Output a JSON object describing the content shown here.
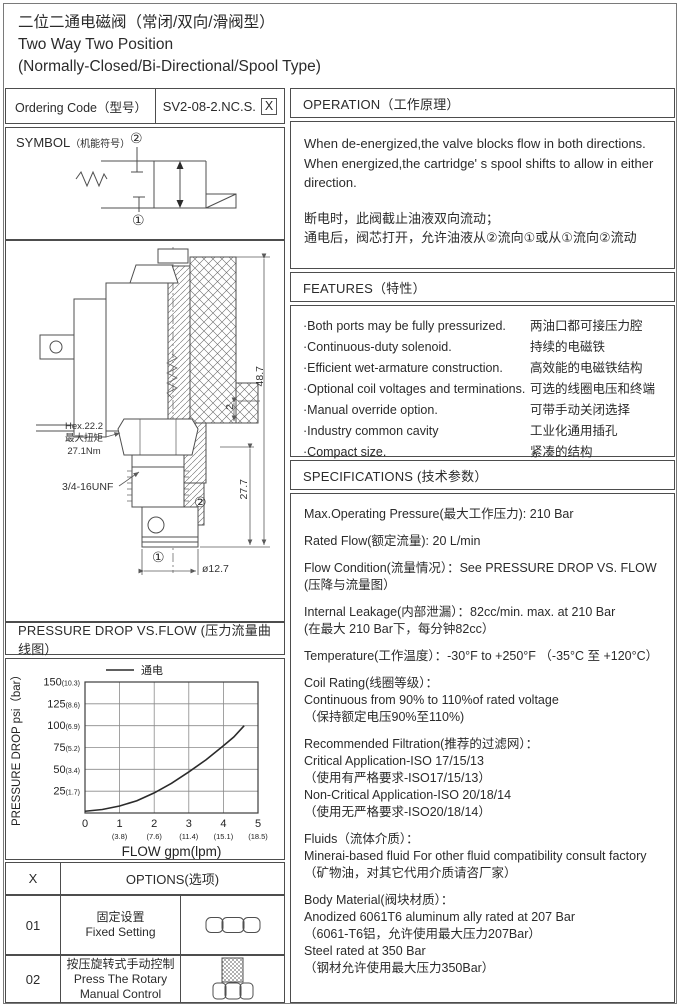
{
  "page": {
    "title_cn": "二位二通电磁阀（常闭/双向/滑阀型）",
    "title_en1": "Two Way Two Position",
    "title_en2": "(Normally-Closed/Bi-Directional/Spool Type)"
  },
  "ordering": {
    "label": "Ordering Code（型号）",
    "code": "SV2-08-2.NC.S.",
    "code_suffix": "X"
  },
  "symbol": {
    "label": "SYMBOL",
    "label_cn": "（机能符号）",
    "port_top": "②",
    "port_bottom": "①"
  },
  "drawing": {
    "hex_line1": "Hex.22.2",
    "hex_line2": "最大扭矩",
    "hex_line3": "27.1Nm",
    "thread": "3/4-16UNF",
    "dim_height": "48.7",
    "dim_mid": "27.7",
    "dim_flange": "2",
    "dim_diameter": "ø12.7",
    "port_top": "②",
    "port_bottom": "①"
  },
  "operation": {
    "header": "OPERATION（工作原理）",
    "en": "When de-energized,the valve blocks flow in both directions. When energized,the cartridge' s spool shifts to allow in either direction.",
    "cn1": "断电时，此阀截止油液双向流动；",
    "cn2": "通电后，阀芯打开，允许油液从②流向①或从①流向②流动"
  },
  "features": {
    "header": "FEATURES（特性）",
    "items": [
      {
        "en": "·Both ports may be fully pressurized.",
        "cn": "两油口都可接压力腔"
      },
      {
        "en": "·Continuous-duty  solenoid.",
        "cn": "持续的电磁铁"
      },
      {
        "en": "·Efficient wet-armature construction.",
        "cn": "高效能的电磁铁结构"
      },
      {
        "en": "·Optional coil voltages and terminations.",
        "cn": "可选的线圈电压和终端"
      },
      {
        "en": "·Manual override option.",
        "cn": "可带手动关闭选择"
      },
      {
        "en": "·Industry common cavity",
        "cn": "工业化通用插孔"
      },
      {
        "en": "·Compact size.",
        "cn": "紧凑的结构"
      }
    ]
  },
  "specifications": {
    "header": "SPECIFICATIONS (技术参数）",
    "paragraphs": [
      [
        "Max.Operating Pressure(最大工作压力): 210 Bar"
      ],
      [
        "Rated Flow(额定流量): 20 L/min"
      ],
      [
        "Flow Condition(流量情况）：See PRESSURE DROP VS. FLOW",
        "(压降与流量图）"
      ],
      [
        "Internal Leakage(内部泄漏）：82cc/min. max. at 210 Bar",
        "(在最大 210 Bar下，每分钟82cc）"
      ],
      [
        "Temperature(工作温度）：-30°F to +250°F （-35°C 至 +120°C）"
      ],
      [
        "Coil Rating(线圈等级）：",
        "Continuous from 90% to 110%of rated voltage",
        "（保持额定电压90%至110%)"
      ],
      [
        "Recommended Filtration(推荐的过滤网）：",
        "Critical Application-ISO 17/15/13",
        "（使用有严格要求-ISO17/15/13）",
        "Non-Critical Application-ISO 20/18/14",
        "（使用无严格要求-ISO20/18/14）"
      ],
      [
        "Fluids（流体介质）：",
        "Minerai-based fluid For other  fluid compatibility consult  factory",
        "（矿物油，对其它代用介质请咨厂家）"
      ],
      [
        "Body Material(阀块材质）：",
        "Anodized 6061T6 aluminum ally rated at 207 Bar",
        "（6061-T6铝，允许使用最大压力207Bar）",
        "Steel rated at 350 Bar",
        "（钢材允许使用最大压力350Bar）"
      ]
    ]
  },
  "chart": {
    "header": "PRESSURE DROP VS.FLOW  (压力流量曲线图）"
  },
  "chart_data": {
    "type": "line",
    "title": "PRESSURE DROP VS.FLOW (压力流量曲线图)",
    "xlabel": "FLOW gpm(lpm)",
    "ylabel": "PRESSURE DROP psi（bar）",
    "xlim": [
      0,
      5
    ],
    "ylim": [
      0,
      150
    ],
    "grid": true,
    "legend_position": "top-center",
    "legend": [
      "通电"
    ],
    "x_ticks": [
      {
        "gpm": "0",
        "lpm": ""
      },
      {
        "gpm": "1",
        "lpm": "(3.8)"
      },
      {
        "gpm": "2",
        "lpm": "(7.6)"
      },
      {
        "gpm": "3",
        "lpm": "(11.4)"
      },
      {
        "gpm": "4",
        "lpm": "(15.1)"
      },
      {
        "gpm": "5",
        "lpm": "(18.5)"
      }
    ],
    "y_ticks": [
      {
        "psi": "25",
        "bar": "(1.7)"
      },
      {
        "psi": "50",
        "bar": "(3.4)"
      },
      {
        "psi": "75",
        "bar": "(5.2)"
      },
      {
        "psi": "100",
        "bar": "(6.9)"
      },
      {
        "psi": "125",
        "bar": "(8.6)"
      },
      {
        "psi": "150",
        "bar": "(10.3)"
      }
    ],
    "series": [
      {
        "name": "通电",
        "x": [
          0,
          0.5,
          1,
          1.5,
          2,
          2.5,
          3,
          3.5,
          4,
          4.3,
          4.6
        ],
        "y": [
          2,
          4,
          8,
          14,
          23,
          34,
          47,
          61,
          77,
          87,
          100
        ]
      }
    ]
  },
  "options": {
    "col_x": "X",
    "col_options": "OPTIONS(选项)",
    "rows": [
      {
        "code": "01",
        "cn": "固定设置",
        "en": "Fixed Setting",
        "icon": "fixed-setting-nut-icon"
      },
      {
        "code": "02",
        "cn": "按压旋转式手动控制",
        "en": "Press The Rotary",
        "en2": "Manual Control",
        "icon": "rotary-knob-icon"
      }
    ]
  },
  "colors": {
    "ink": "#2b2b2b",
    "border": "#4d4d4d",
    "paper": "#ffffff"
  }
}
